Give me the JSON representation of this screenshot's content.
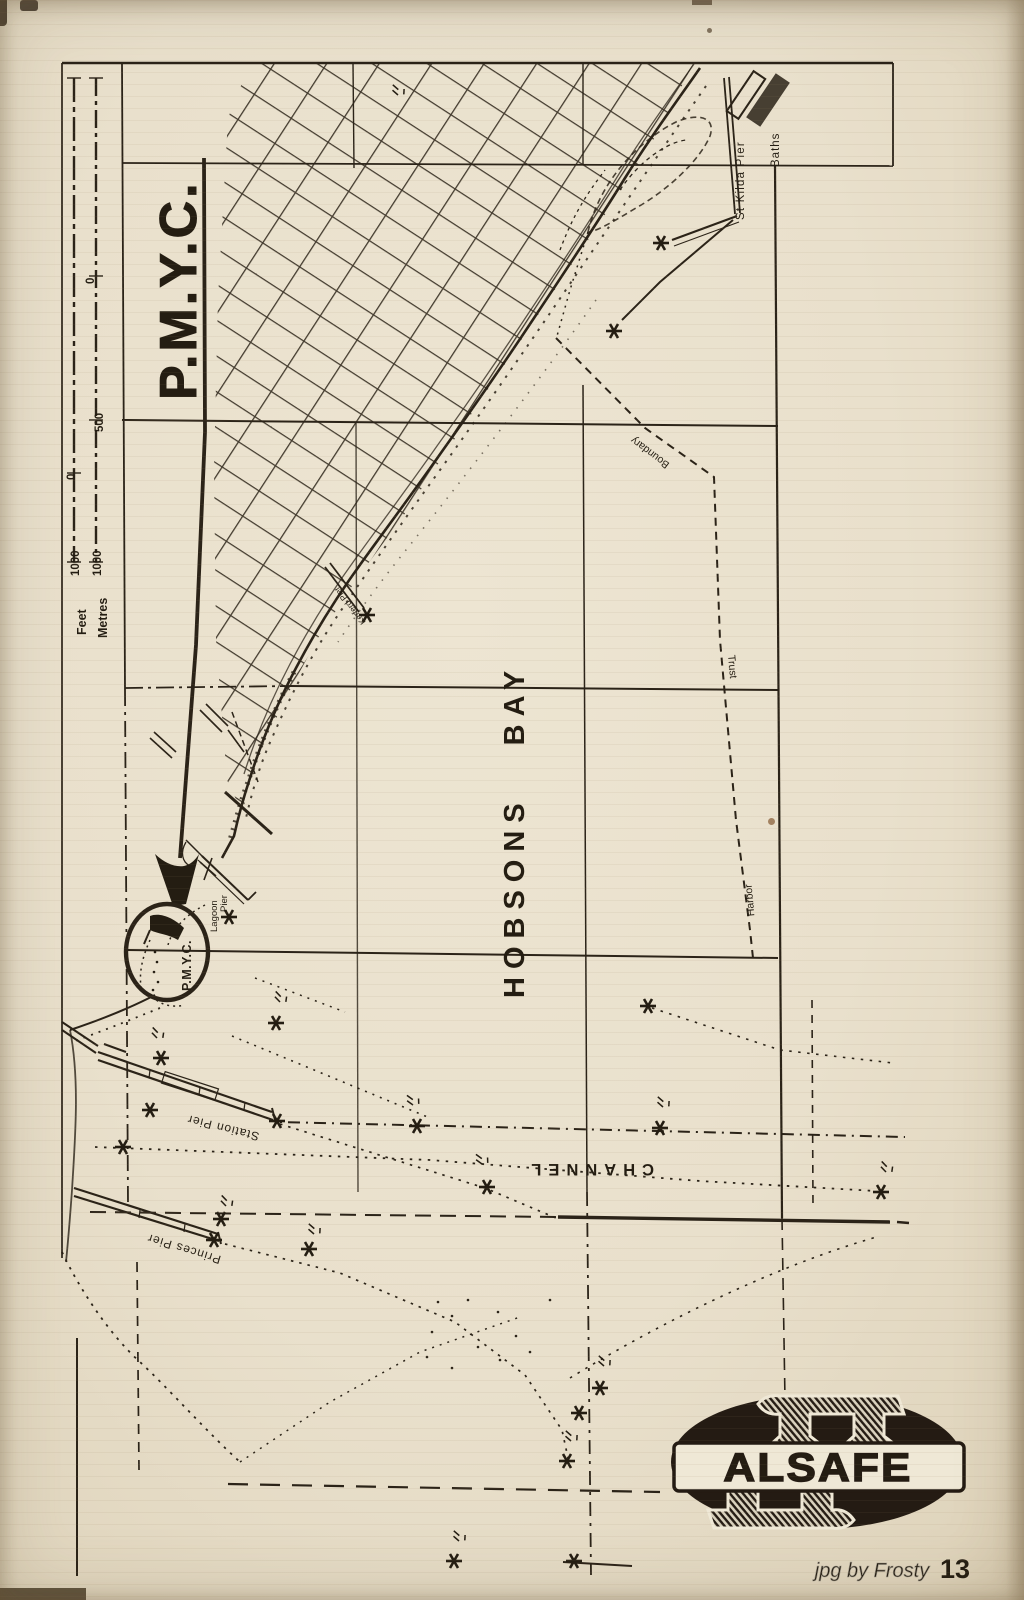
{
  "page": {
    "number": "13",
    "credit": "jpg by Frosty"
  },
  "map": {
    "title": "P.M.Y.C.",
    "scale": {
      "feet_label": "Feet",
      "metres_label": "Metres",
      "feet_1000": "1000",
      "feet_0": "0",
      "metres_1000": "1000",
      "metres_500": "500",
      "metres_0": "0"
    },
    "labels": {
      "bay": "HOBSONS BAY",
      "channel": "CHANNEL",
      "st_kilda_pier": "St Kilda Pier",
      "baths": "Baths",
      "boundary": "Boundary",
      "trust": "Trust",
      "harbor": "Harbor",
      "lagoon": "Lagoon",
      "lagoon_pier": "Pier",
      "kerferd_pier": "Kerferd Pier",
      "station_pier": "Station Pier",
      "princes_pier": "Princes Pier",
      "pmyc_marker": "P.M.Y.C."
    }
  },
  "logo": {
    "text": "ALSAFE"
  },
  "colors": {
    "paper": "#e9e0cc",
    "ink": "#2b2318",
    "logo_ink": "#241b13",
    "watermark": "#a39d90"
  }
}
